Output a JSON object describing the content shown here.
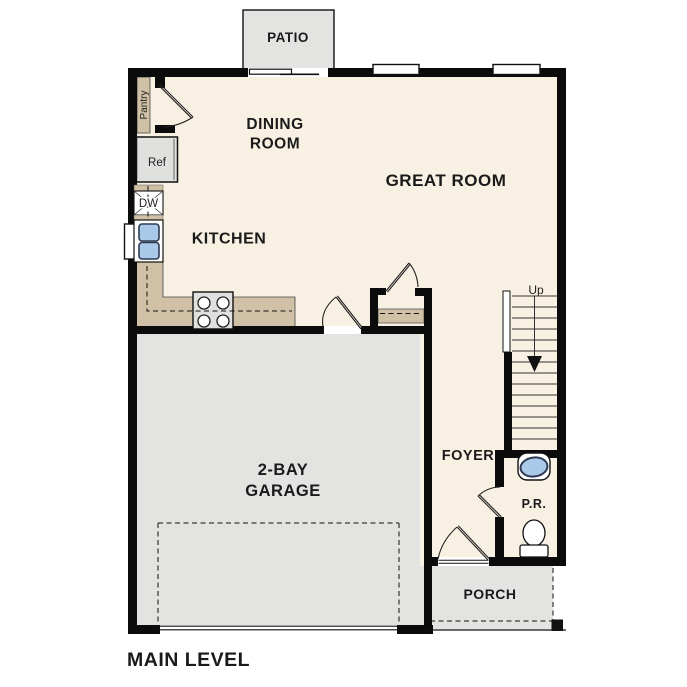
{
  "plan_title": "MAIN LEVEL",
  "rooms": {
    "patio": {
      "label": "PATIO"
    },
    "dining": {
      "line1": "DINING",
      "line2": "ROOM"
    },
    "great_room": {
      "label": "GREAT ROOM"
    },
    "kitchen": {
      "label": "KITCHEN"
    },
    "garage": {
      "line1": "2-BAY",
      "line2": "GARAGE"
    },
    "foyer": {
      "label": "FOYER"
    },
    "powder_room": {
      "label": "P.R."
    },
    "porch": {
      "label": "PORCH"
    }
  },
  "fixtures": {
    "pantry": {
      "label": "Pantry"
    },
    "refrigerator": {
      "label": "Ref"
    },
    "dishwasher": {
      "label": "DW"
    },
    "stairs": {
      "direction_label": "Up"
    }
  },
  "colors": {
    "background": "#ffffff",
    "wall": "#0b0b0b",
    "floor": "#f8f1e3",
    "hardscape": "#e3e3e1",
    "appliance_gray": "#e0e0de",
    "counter": "#d0c1a6",
    "fixture_blue": "#aac9e9",
    "fixture_blue_border": "#2e3b52"
  }
}
